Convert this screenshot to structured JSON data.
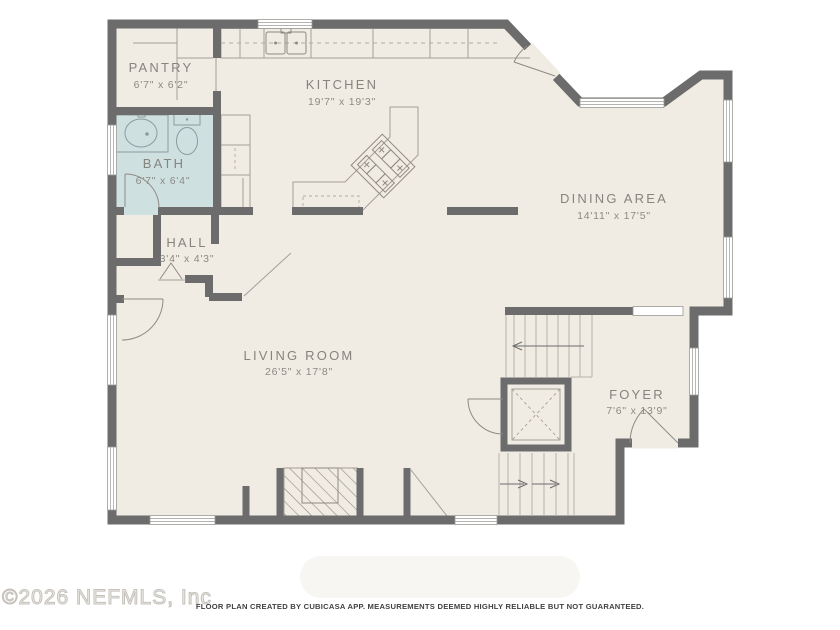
{
  "plan": {
    "rooms": [
      {
        "name": "PANTRY",
        "dims": "6'7\" x 6'2\""
      },
      {
        "name": "KITCHEN",
        "dims": "19'7\" x 19'3\""
      },
      {
        "name": "BATH",
        "dims": "6'7\" x 6'4\""
      },
      {
        "name": "HALL",
        "dims": "3'4\" x 4'3\""
      },
      {
        "name": "DINING AREA",
        "dims": "14'11\" x 17'5\""
      },
      {
        "name": "LIVING ROOM",
        "dims": "26'5\" x 17'8\""
      },
      {
        "name": "FOYER",
        "dims": "7'6\" x 13'9\""
      }
    ],
    "colors": {
      "floor": "#f1ece3",
      "bath_floor": "#cfe0e1",
      "wall": "#6c6c6c"
    }
  },
  "footer": {
    "watermark": "©2026 NEFMLS, Inc",
    "disclaimer": "FLOOR PLAN CREATED BY CUBICASA APP. MEASUREMENTS DEEMED HIGHLY RELIABLE BUT NOT GUARANTEED."
  }
}
